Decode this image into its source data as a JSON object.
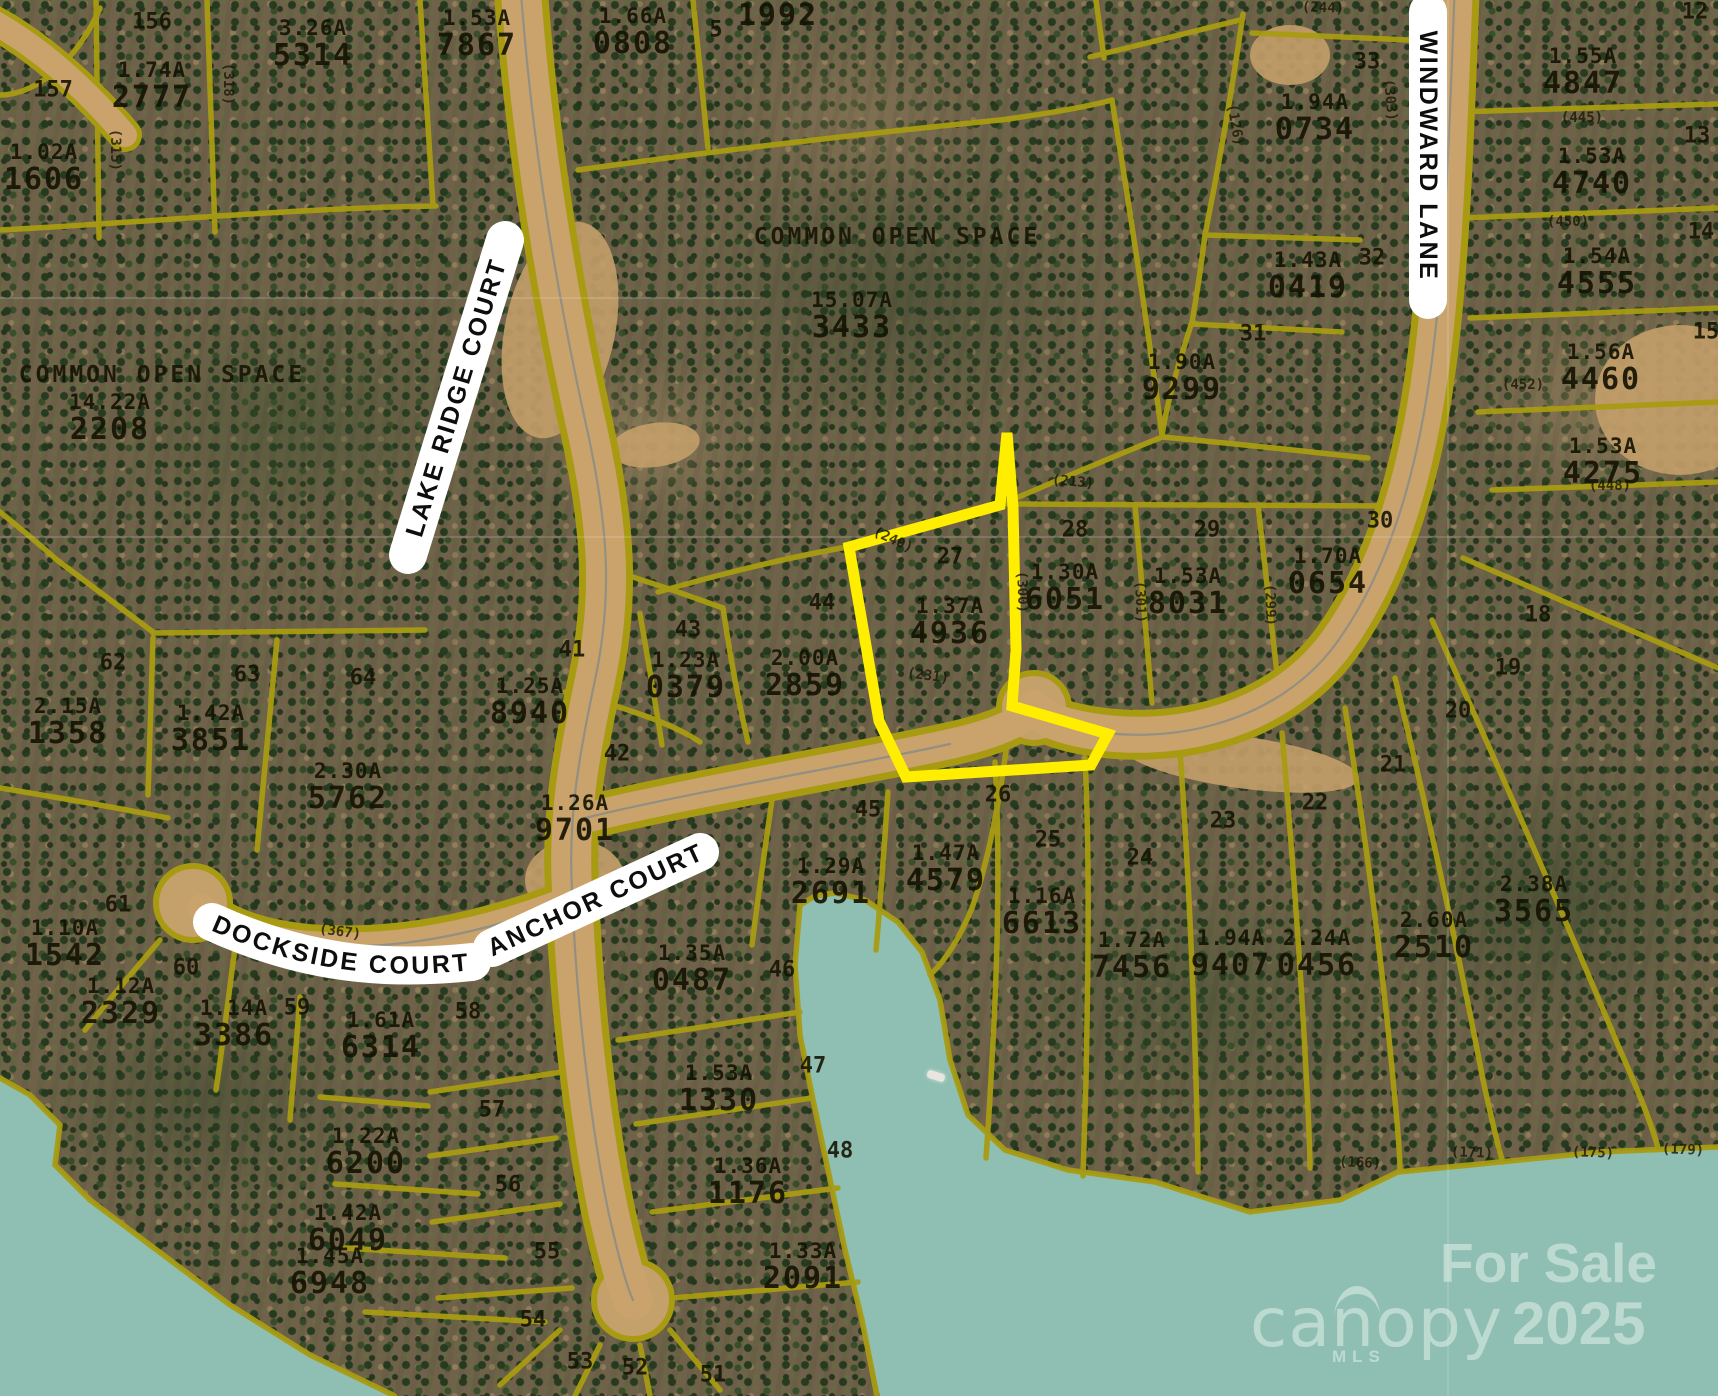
{
  "map": {
    "streets": [
      {
        "id": "lake-ridge-court",
        "label": "LAKE RIDGE COURT"
      },
      {
        "id": "windward-lane",
        "label": "WINDWARD LANE"
      },
      {
        "id": "dockside-court",
        "label": "DOCKSIDE COURT"
      },
      {
        "id": "anchor-court",
        "label": "ANCHOR COURT"
      }
    ],
    "open_space_labels": [
      {
        "x": 897,
        "y": 237,
        "label": "COMMON OPEN SPACE"
      },
      {
        "x": 162,
        "y": 375,
        "label": "COMMON OPEN SPACE"
      }
    ],
    "highlight": {
      "lot": "27",
      "acreage": "1.37A",
      "number": "4936",
      "points": "849,547 1000,505 1007,433 1013,507 1016,650 1012,706 1108,734 1091,765 906,777 879,721"
    },
    "parcels": [
      {
        "x": 152,
        "y": 60,
        "a": "1.74A",
        "n": "2777"
      },
      {
        "x": 313,
        "y": 18,
        "a": "3.26A",
        "n": "5314"
      },
      {
        "x": 44,
        "y": 142,
        "a": "1.02A",
        "n": "1606"
      },
      {
        "x": 477,
        "y": 8,
        "a": "1.53A",
        "n": "7867"
      },
      {
        "x": 633,
        "y": 6,
        "a": "1.66A",
        "n": "0808"
      },
      {
        "x": 778,
        "y": 0,
        "a": "",
        "n": "1992"
      },
      {
        "x": 1315,
        "y": 92,
        "a": "1.94A",
        "n": "0734"
      },
      {
        "x": 1308,
        "y": 250,
        "a": "1.43A",
        "n": "0419"
      },
      {
        "x": 1182,
        "y": 352,
        "a": "1.90A",
        "n": "9299"
      },
      {
        "x": 1583,
        "y": 46,
        "a": "1.55A",
        "n": "4847"
      },
      {
        "x": 1592,
        "y": 146,
        "a": "1.53A",
        "n": "4740"
      },
      {
        "x": 1597,
        "y": 246,
        "a": "1.54A",
        "n": "4555"
      },
      {
        "x": 1601,
        "y": 342,
        "a": "1.56A",
        "n": "4460"
      },
      {
        "x": 1603,
        "y": 436,
        "a": "1.53A",
        "n": "4275"
      },
      {
        "x": 852,
        "y": 290,
        "a": "15.07A",
        "n": "3433"
      },
      {
        "x": 110,
        "y": 392,
        "a": "14.22A",
        "n": "2208"
      },
      {
        "x": 950,
        "y": 596,
        "a": "1.37A",
        "n": "4936"
      },
      {
        "x": 1065,
        "y": 562,
        "a": "1.30A",
        "n": "6051"
      },
      {
        "x": 1188,
        "y": 566,
        "a": "1.53A",
        "n": "8031"
      },
      {
        "x": 1328,
        "y": 546,
        "a": "1.70A",
        "n": "0654"
      },
      {
        "x": 805,
        "y": 648,
        "a": "2.00A",
        "n": "2859"
      },
      {
        "x": 686,
        "y": 650,
        "a": "1.23A",
        "n": "0379"
      },
      {
        "x": 530,
        "y": 676,
        "a": "1.25A",
        "n": "8940"
      },
      {
        "x": 575,
        "y": 793,
        "a": "1.26A",
        "n": "9701"
      },
      {
        "x": 211,
        "y": 703,
        "a": "1.42A",
        "n": "3851"
      },
      {
        "x": 68,
        "y": 696,
        "a": "2.15A",
        "n": "1358"
      },
      {
        "x": 348,
        "y": 761,
        "a": "2.30A",
        "n": "5762"
      },
      {
        "x": 65,
        "y": 918,
        "a": "1.10A",
        "n": "1542"
      },
      {
        "x": 121,
        "y": 976,
        "a": "1.12A",
        "n": "2329"
      },
      {
        "x": 234,
        "y": 998,
        "a": "1.14A",
        "n": "3386"
      },
      {
        "x": 381,
        "y": 1010,
        "a": "1.61A",
        "n": "6314"
      },
      {
        "x": 366,
        "y": 1126,
        "a": "1.22A",
        "n": "6200"
      },
      {
        "x": 348,
        "y": 1203,
        "a": "1.42A",
        "n": "6049"
      },
      {
        "x": 330,
        "y": 1246,
        "a": "1.45A",
        "n": "6948"
      },
      {
        "x": 692,
        "y": 943,
        "a": "1.35A",
        "n": "0487"
      },
      {
        "x": 719,
        "y": 1063,
        "a": "1.53A",
        "n": "1330"
      },
      {
        "x": 748,
        "y": 1156,
        "a": "1.36A",
        "n": "1176"
      },
      {
        "x": 803,
        "y": 1241,
        "a": "1.33A",
        "n": "2091"
      },
      {
        "x": 831,
        "y": 856,
        "a": "1.29A",
        "n": "2691"
      },
      {
        "x": 946,
        "y": 843,
        "a": "1.47A",
        "n": "4579"
      },
      {
        "x": 1042,
        "y": 886,
        "a": "1.16A",
        "n": "6613"
      },
      {
        "x": 1132,
        "y": 930,
        "a": "1.72A",
        "n": "7456"
      },
      {
        "x": 1231,
        "y": 928,
        "a": "1.94A",
        "n": "9407"
      },
      {
        "x": 1317,
        "y": 928,
        "a": "2.24A",
        "n": "0456"
      },
      {
        "x": 1434,
        "y": 910,
        "a": "2.60A",
        "n": "2510"
      },
      {
        "x": 1534,
        "y": 874,
        "a": "2.38A",
        "n": "3565"
      }
    ],
    "lot_numbers": [
      {
        "x": 152,
        "y": 22,
        "n": "156"
      },
      {
        "x": 53,
        "y": 90,
        "n": "157"
      },
      {
        "x": 716,
        "y": 30,
        "n": "5"
      },
      {
        "x": 1367,
        "y": 62,
        "n": "33"
      },
      {
        "x": 1372,
        "y": 258,
        "n": "32"
      },
      {
        "x": 1253,
        "y": 334,
        "n": "31"
      },
      {
        "x": 1695,
        "y": 12,
        "n": "12"
      },
      {
        "x": 1697,
        "y": 136,
        "n": "13"
      },
      {
        "x": 1701,
        "y": 232,
        "n": "14"
      },
      {
        "x": 1706,
        "y": 332,
        "n": "15"
      },
      {
        "x": 950,
        "y": 557,
        "n": "27"
      },
      {
        "x": 1075,
        "y": 530,
        "n": "28"
      },
      {
        "x": 1207,
        "y": 530,
        "n": "29"
      },
      {
        "x": 1380,
        "y": 521,
        "n": "30"
      },
      {
        "x": 822,
        "y": 603,
        "n": "44"
      },
      {
        "x": 688,
        "y": 630,
        "n": "43"
      },
      {
        "x": 572,
        "y": 650,
        "n": "41"
      },
      {
        "x": 617,
        "y": 754,
        "n": "42"
      },
      {
        "x": 247,
        "y": 675,
        "n": "63"
      },
      {
        "x": 113,
        "y": 663,
        "n": "62"
      },
      {
        "x": 363,
        "y": 678,
        "n": "64"
      },
      {
        "x": 118,
        "y": 905,
        "n": "61"
      },
      {
        "x": 186,
        "y": 968,
        "n": "60"
      },
      {
        "x": 297,
        "y": 1008,
        "n": "59"
      },
      {
        "x": 468,
        "y": 1012,
        "n": "58"
      },
      {
        "x": 492,
        "y": 1110,
        "n": "57"
      },
      {
        "x": 508,
        "y": 1185,
        "n": "56"
      },
      {
        "x": 547,
        "y": 1252,
        "n": "55"
      },
      {
        "x": 533,
        "y": 1320,
        "n": "54"
      },
      {
        "x": 580,
        "y": 1362,
        "n": "53"
      },
      {
        "x": 635,
        "y": 1368,
        "n": "52"
      },
      {
        "x": 713,
        "y": 1375,
        "n": "51"
      },
      {
        "x": 782,
        "y": 970,
        "n": "46"
      },
      {
        "x": 813,
        "y": 1066,
        "n": "47"
      },
      {
        "x": 840,
        "y": 1151,
        "n": "48"
      },
      {
        "x": 868,
        "y": 810,
        "n": "45"
      },
      {
        "x": 998,
        "y": 795,
        "n": "26"
      },
      {
        "x": 1048,
        "y": 840,
        "n": "25"
      },
      {
        "x": 1140,
        "y": 858,
        "n": "24"
      },
      {
        "x": 1223,
        "y": 821,
        "n": "23"
      },
      {
        "x": 1315,
        "y": 803,
        "n": "22"
      },
      {
        "x": 1393,
        "y": 765,
        "n": "21"
      },
      {
        "x": 1458,
        "y": 711,
        "n": "20"
      },
      {
        "x": 1508,
        "y": 668,
        "n": "19"
      },
      {
        "x": 1538,
        "y": 615,
        "n": "18"
      }
    ],
    "dimensions": [
      {
        "x": 1323,
        "y": 8,
        "t": "(244)",
        "r": 2
      },
      {
        "x": 1582,
        "y": 118,
        "t": "(445)",
        "r": 0
      },
      {
        "x": 1568,
        "y": 222,
        "t": "(450)",
        "r": 0
      },
      {
        "x": 1523,
        "y": 385,
        "t": "(452)",
        "r": 0
      },
      {
        "x": 1610,
        "y": 486,
        "t": "(448)",
        "r": 0
      },
      {
        "x": 228,
        "y": 84,
        "t": "(318)",
        "r": 90
      },
      {
        "x": 115,
        "y": 150,
        "t": "(315)",
        "r": 90
      },
      {
        "x": 1390,
        "y": 100,
        "t": "(303)",
        "r": 85
      },
      {
        "x": 1235,
        "y": 125,
        "t": "(126)",
        "r": 80
      },
      {
        "x": 1073,
        "y": 482,
        "t": "(213)",
        "r": 5
      },
      {
        "x": 1022,
        "y": 592,
        "t": "(300)",
        "r": 88
      },
      {
        "x": 1140,
        "y": 602,
        "t": "(301)",
        "r": 88
      },
      {
        "x": 1270,
        "y": 605,
        "t": "(299)",
        "r": 88
      },
      {
        "x": 893,
        "y": 540,
        "t": "(240)",
        "r": 25
      },
      {
        "x": 928,
        "y": 676,
        "t": "(231)",
        "r": 8
      },
      {
        "x": 340,
        "y": 932,
        "t": "(367)",
        "r": 8
      },
      {
        "x": 1360,
        "y": 1163,
        "t": "(166)",
        "r": 3
      },
      {
        "x": 1472,
        "y": 1153,
        "t": "(171)",
        "r": 2
      },
      {
        "x": 1593,
        "y": 1153,
        "t": "(175)",
        "r": 2
      },
      {
        "x": 1683,
        "y": 1150,
        "t": "(179)",
        "r": 2
      }
    ],
    "watermark": {
      "title": "For Sale",
      "brand": "canopy",
      "brand_sub": "MLS",
      "year": "2025"
    },
    "colors": {
      "parcel_line": "#a89b12",
      "highlight": "#ffee00",
      "water": "#8fbfb2",
      "road": "#c9a36b",
      "label_ink": "#16140a",
      "street_pill": "#ffffff"
    }
  }
}
